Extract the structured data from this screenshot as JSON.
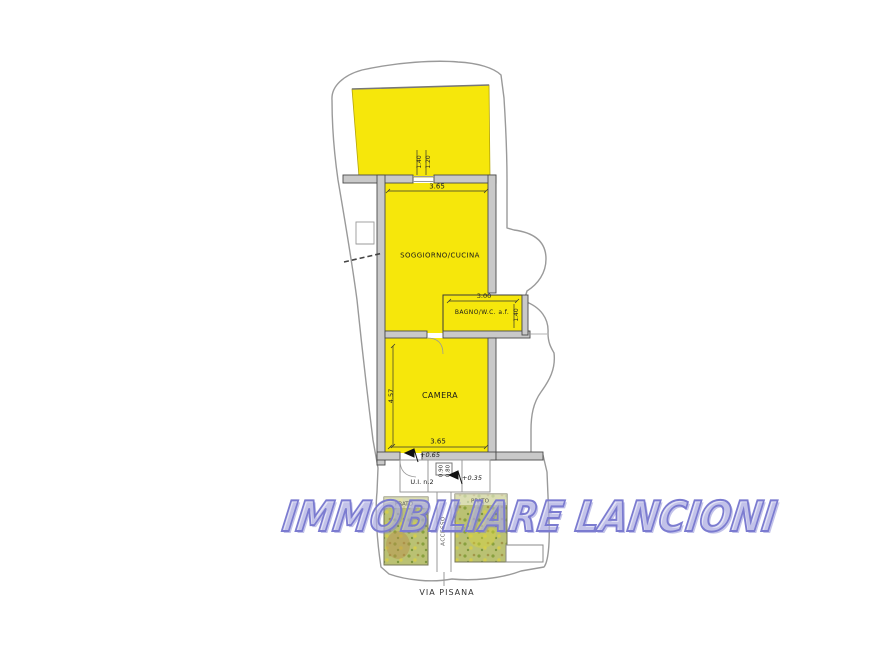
{
  "watermark": {
    "text": "IMMOBILIARE LANCIONI",
    "color": "#7b7bd0"
  },
  "street": {
    "label": "VIA PISANA"
  },
  "rooms": {
    "soggiorno": {
      "label": "SOGGIORNO/CUCINA"
    },
    "bagno": {
      "label": "BAGNO/W.C. a.f."
    },
    "camera": {
      "label": "CAMERA"
    },
    "prato_left": {
      "label": "PRATO"
    },
    "prato_right": {
      "label": "PRATO"
    },
    "accesso": {
      "label": "ACCESSO"
    },
    "unit": {
      "label": "U.I. n.2"
    }
  },
  "dimensions": {
    "opening_width": "1.40",
    "opening_depth": "1.20",
    "soggiorno_width": "3.65",
    "bagno_width": "3.00",
    "bagno_depth": "1.40",
    "camera_width": "3.65",
    "camera_height": "4.57",
    "porch_a": "0.90",
    "porch_b": "0.80",
    "level_entrance": "+0.65",
    "level_porch": "+0.35"
  },
  "colors": {
    "room_fill": "#f6e70b",
    "wall_fill": "#c9c9c9",
    "wall_edge": "#4a4a4a",
    "lawn_fill": "#bac173",
    "boundary": "#9a9a9a",
    "watermark": "#7b7bd0"
  }
}
